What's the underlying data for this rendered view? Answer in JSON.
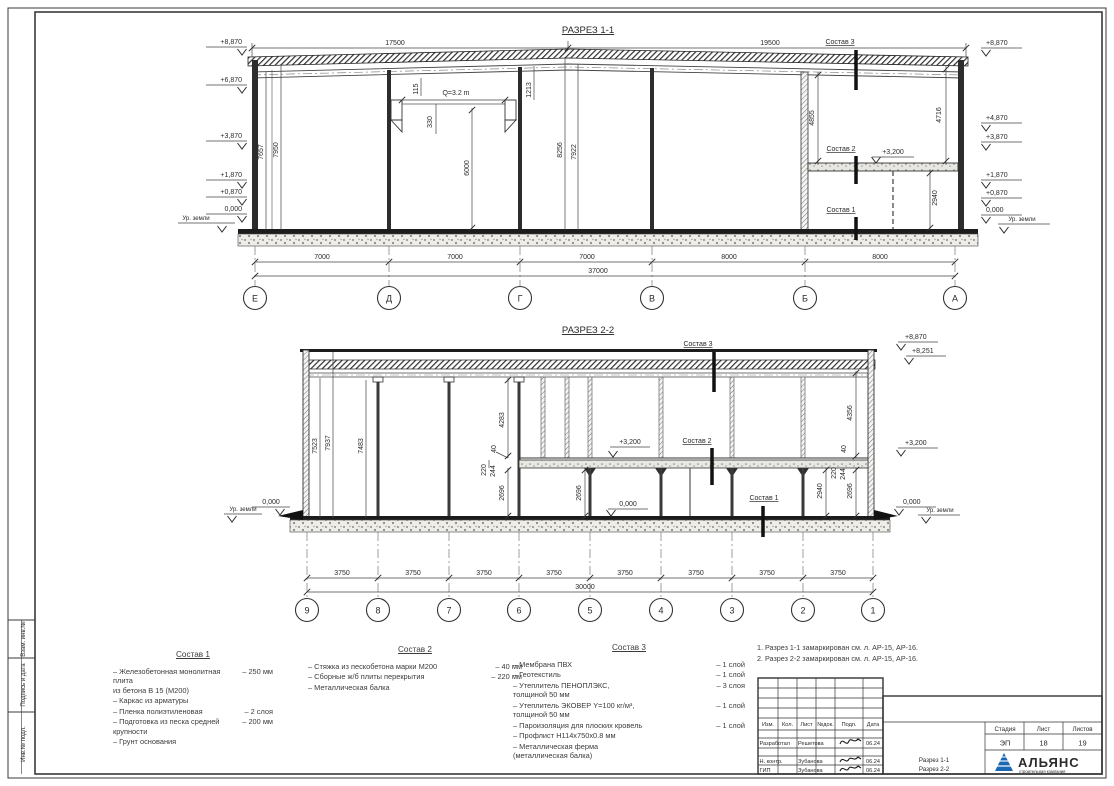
{
  "frame": {
    "side_labels": [
      "Взам. инв.№",
      "Подпись  и  дата",
      "Инв.№ подл."
    ]
  },
  "colors": {
    "logo_blue": "#1b67b3"
  },
  "s1": {
    "title": "РАЗРЕЗ 1-1",
    "dim_left_span": "17500",
    "dim_right_span": "19500",
    "elev_left": [
      "+8,870",
      "+6,870",
      "+3,870",
      "+1,870",
      "+0,870",
      "0,000"
    ],
    "elev_right": [
      "+8,870",
      "+4,870",
      "+3,870",
      "+1,870",
      "+0,870",
      "0,000"
    ],
    "ground_label": "Ур. земли",
    "crane_cap": "Q=3.2 m",
    "d115": "115",
    "d330": "330",
    "d6000": "6000",
    "d1213": "1213",
    "d7657": "7657",
    "d7950": "7950",
    "d8256": "8256",
    "d7922": "7922",
    "d4855": "4855",
    "d4716": "4716",
    "d2940": "2940",
    "lvl_3200": "+3,200",
    "mark_s3": "Состав 3",
    "mark_s2": "Состав 2",
    "mark_s1": "Состав 1",
    "spans": [
      "7000",
      "7000",
      "7000",
      "8000",
      "8000"
    ],
    "total": "37000",
    "axes": [
      "Е",
      "Д",
      "Г",
      "В",
      "Б",
      "А"
    ]
  },
  "s2": {
    "title": "РАЗРЕЗ 2-2",
    "elev_8870": "+8,870",
    "elev_8251": "+8,251",
    "lvl_3200": "+3,200",
    "lvl_0": "0,000",
    "ground_label": "Ур. земли",
    "d7523": "7523",
    "d7937": "7937",
    "d7483": "7483",
    "d4283": "4283",
    "d40": "40",
    "d220": "220",
    "d244": "244",
    "d2696": "2696",
    "d4356": "4356",
    "d2940": "2940",
    "mark_s3": "Состав 3",
    "mark_s2": "Состав 2",
    "mark_s1": "Состав 1",
    "span": "3750",
    "total": "30000",
    "axes": [
      "9",
      "8",
      "7",
      "6",
      "5",
      "4",
      "3",
      "2",
      "1"
    ]
  },
  "sostav1": {
    "title": "Состав 1",
    "items": [
      {
        "label": "– Железобетонная  монолитная плита\nиз бетона В 15 (М200)",
        "value": "– 250 мм"
      },
      {
        "label": "– Каркас из арматуры",
        "value": ""
      },
      {
        "label": "– Пленка полиэтиленовая",
        "value": "– 2 слоя"
      },
      {
        "label": "– Подготовка из песка средней\nкрупности",
        "value": "– 200 мм"
      },
      {
        "label": "– Грунт основания",
        "value": ""
      }
    ]
  },
  "sostav2": {
    "title": "Состав 2",
    "items": [
      {
        "label": "– Стяжка из пескобетона марки М200",
        "value": "– 40 мм"
      },
      {
        "label": "– Сборные ж/б плиты перекрытия",
        "value": "– 220 мм"
      },
      {
        "label": "– Металлическая балка",
        "value": ""
      }
    ]
  },
  "sostav3": {
    "title": "Состав 3",
    "items": [
      {
        "label": "– Мембрана ПВХ",
        "value": "– 1 слой"
      },
      {
        "label": "– Геотекстиль",
        "value": "– 1 слой"
      },
      {
        "label": "– Утеплитель ПЕНОПЛЭКС,\nтолщиной 50 мм",
        "value": "– 3 слоя"
      },
      {
        "label": "– Утеплитель ЭКОВЕР Y=100 кг/м³,\nтолщиной 50 мм",
        "value": "– 1 слой"
      },
      {
        "label": "– Пароизоляция для плоских кровель",
        "value": "– 1 слой"
      },
      {
        "label": "– Профлист  Н114х750х0.8 мм",
        "value": ""
      },
      {
        "label": "– Металлическая ферма\n(металлическая балка)",
        "value": ""
      }
    ]
  },
  "notes": [
    "1. Разрез 1-1 замаркирован см. л. АР-15, АР-16.",
    "2. Разрез 2-2 замаркирован см. л. АР-15, АР-16."
  ],
  "titleblock": {
    "header": [
      "Изм.",
      "Кол.",
      "Лист",
      "№док.",
      "Подп.",
      "Дата"
    ],
    "rows": [
      {
        "role": "Разработал",
        "name": "Решетова",
        "date": "06.24"
      },
      {
        "role": "Н. контр.",
        "name": "Зубанова",
        "date": "06.24"
      },
      {
        "role": "ГИП",
        "name": "Зубанова",
        "date": "06.24"
      }
    ],
    "stage_label": "Стадия",
    "sheet_label": "Лист",
    "sheets_label": "Листов",
    "stage": "ЭП",
    "sheet": "18",
    "sheets": "19",
    "doc1": "Разрез 1-1",
    "doc2": "Разрез 2-2",
    "logo": "АЛЬЯНС",
    "logo_sub": "строительная компания"
  }
}
